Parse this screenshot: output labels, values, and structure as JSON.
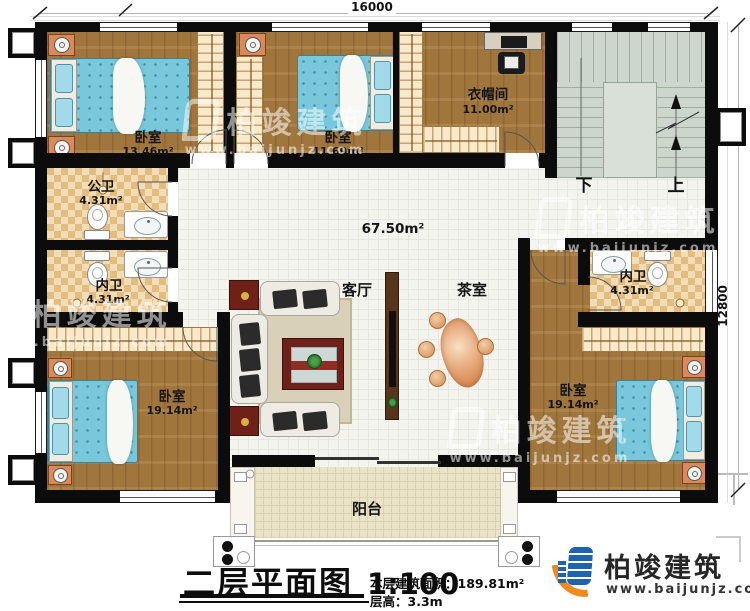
{
  "plan": {
    "dimension_width": "16000",
    "dimension_depth": "12800",
    "central_area": "67.50m²",
    "rooms": {
      "bedroom_top_left": {
        "name": "卧室",
        "area": "13.46m²"
      },
      "bedroom_top_mid": {
        "name": "卧室",
        "area": "11.69m²"
      },
      "cloakroom": {
        "name": "衣帽间",
        "area": "11.00m²"
      },
      "public_bath": {
        "name": "公卫",
        "area": "4.31m²"
      },
      "ensuite_left": {
        "name": "内卫",
        "area": "4.31m²"
      },
      "ensuite_right": {
        "name": "内卫",
        "area": "4.31m²"
      },
      "bedroom_bottom_left": {
        "name": "卧室",
        "area": "19.14m²"
      },
      "bedroom_bottom_right": {
        "name": "卧室",
        "area": "19.14m²"
      },
      "living_room": {
        "name": "客厅"
      },
      "tea_room": {
        "name": "茶室"
      },
      "balcony": {
        "name": "阳台"
      }
    },
    "stairs": {
      "down_label": "下",
      "up_label": "上"
    }
  },
  "title_block": {
    "title": "二层平面图",
    "scale": "1:100",
    "area_label": "本层建筑面积：",
    "area_value": "189.81m²",
    "height_label": "层高：",
    "height_value": "3.3m"
  },
  "brand": {
    "name": "柏竣建筑",
    "website": "www.baijunjz.com"
  },
  "watermark": {
    "name": "柏竣建筑",
    "website": "www.baijunjz.com"
  },
  "colors": {
    "wall": "#0c0c0c",
    "wood_floor": "#a87c40",
    "bed": "#78c7da",
    "brand_blue": "#1f62ad",
    "brand_orange": "#f08a1d"
  }
}
